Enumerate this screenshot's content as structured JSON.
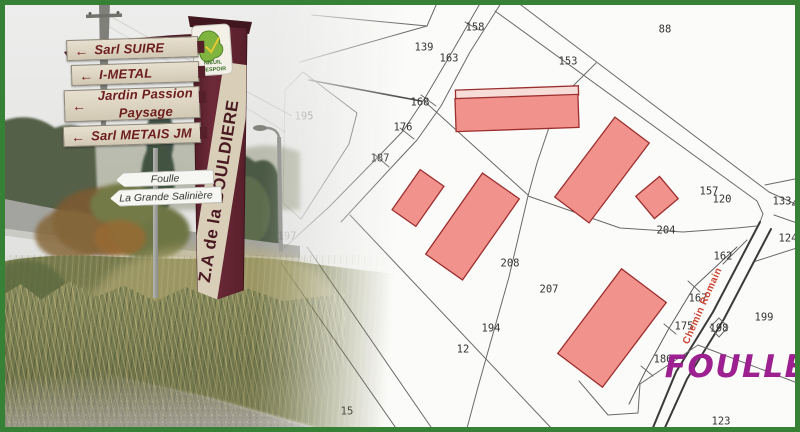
{
  "frame": {
    "border_color": "#368136"
  },
  "photo": {
    "post_sign": {
      "text": "Z.A de la BOULDIERE"
    },
    "logo": {
      "line1": "NIEUIL",
      "line2": "L'ESPOIR"
    },
    "directional_signs": {
      "s1": {
        "arrow": "←",
        "l1": "Sarl SUIRE"
      },
      "s2": {
        "arrow": "←",
        "l1": "I-METAL"
      },
      "s3": {
        "arrow": "←",
        "l1": "Jardin Passion",
        "l2": "Paysage"
      },
      "s4": {
        "arrow": "←",
        "l1": "Sarl METAIS JM"
      }
    },
    "arrow_signs": {
      "a": {
        "label": "Foulle"
      },
      "b": {
        "label": "La Grande Salinière"
      }
    }
  },
  "map": {
    "watermark": "FOULLE",
    "road_label": "Chemin Romain",
    "road_label_pos": {
      "x": 705,
      "y": 307,
      "angle": -66
    },
    "watermark_pos": {
      "x": 736,
      "y": 377
    },
    "colors": {
      "bg": "#fbfbf9",
      "line": "#6a6a6a",
      "label": "#333333",
      "building_fill": "#f2928c",
      "building_stroke": "#9c2f2f",
      "watermark": "#9c2090",
      "road_label_color": "#cc4433"
    },
    "parcel_labels": [
      {
        "t": "139",
        "x": 424,
        "y": 47
      },
      {
        "t": "158",
        "x": 475,
        "y": 27
      },
      {
        "t": "163",
        "x": 449,
        "y": 58
      },
      {
        "t": "153",
        "x": 568,
        "y": 61
      },
      {
        "t": "88",
        "x": 665,
        "y": 29
      },
      {
        "t": "168",
        "x": 420,
        "y": 102
      },
      {
        "t": "176",
        "x": 403,
        "y": 127
      },
      {
        "t": "187",
        "x": 380,
        "y": 158
      },
      {
        "t": "195",
        "x": 304,
        "y": 116
      },
      {
        "t": "197",
        "x": 287,
        "y": 236
      },
      {
        "t": "208",
        "x": 510,
        "y": 263
      },
      {
        "t": "207",
        "x": 549,
        "y": 289
      },
      {
        "t": "204",
        "x": 666,
        "y": 230
      },
      {
        "t": "194",
        "x": 491,
        "y": 328
      },
      {
        "t": "12",
        "x": 463,
        "y": 349
      },
      {
        "t": "15",
        "x": 347,
        "y": 411
      },
      {
        "t": "157",
        "x": 709,
        "y": 191
      },
      {
        "t": "120",
        "x": 722,
        "y": 199
      },
      {
        "t": "133",
        "x": 782,
        "y": 201
      },
      {
        "t": "49",
        "x": 798,
        "y": 204
      },
      {
        "t": "124",
        "x": 788,
        "y": 238
      },
      {
        "t": "162",
        "x": 723,
        "y": 256
      },
      {
        "t": "167",
        "x": 698,
        "y": 298
      },
      {
        "t": "175",
        "x": 684,
        "y": 326
      },
      {
        "t": "198",
        "x": 719,
        "y": 328
      },
      {
        "t": "199",
        "x": 764,
        "y": 317
      },
      {
        "t": "186",
        "x": 663,
        "y": 359
      },
      {
        "t": "123",
        "x": 721,
        "y": 421
      }
    ],
    "buildings": [
      {
        "cx": 517,
        "cy": 92.5,
        "w": 123,
        "h": 9,
        "a": -2,
        "f": "#f7ddd8"
      },
      {
        "cx": 517,
        "cy": 113,
        "w": 123,
        "h": 33,
        "a": -2
      },
      {
        "cx": 418,
        "cy": 198,
        "w": 29,
        "h": 49,
        "a": 35
      },
      {
        "cx": 472.5,
        "cy": 226.5,
        "w": 45,
        "h": 99,
        "a": 35
      },
      {
        "cx": 602,
        "cy": 170,
        "w": 43,
        "h": 100,
        "a": 37
      },
      {
        "cx": 657,
        "cy": 197.5,
        "w": 29,
        "h": 31,
        "a": 50
      },
      {
        "cx": 612,
        "cy": 328,
        "w": 56,
        "h": 106,
        "a": 37
      }
    ],
    "lines": [
      {
        "p": "482,0 452,52 425,98 403,131 377,158 329,207 284,248"
      },
      {
        "p": "503,0 470,52 441,106 417,140 389,170 341,222"
      },
      {
        "p": "465,22 479,30"
      },
      {
        "p": "421,95 436,106"
      },
      {
        "p": "400,128 414,139"
      },
      {
        "p": "374,154 389,167"
      },
      {
        "p": "312,15 427,26"
      },
      {
        "p": "300,62 427,26"
      },
      {
        "p": "427,26 437,3"
      },
      {
        "p": "303,72 357,113 349,144 301,219 283,203 285,90 303,72"
      },
      {
        "p": "309,80 421,101",
        "c": "#4f4f4f",
        "w": 1.6
      },
      {
        "p": "517,2 769,192 800,206"
      },
      {
        "p": "495,11 757,201 763,214 760,222"
      },
      {
        "p": "765,185 800,178"
      },
      {
        "p": "774,215 800,224"
      },
      {
        "p": "753,262 800,247"
      },
      {
        "p": "747,240 723,264"
      },
      {
        "p": "760,222 713,312 676,372 652,430",
        "c": "#3a3a3a",
        "w": 2
      },
      {
        "p": "771,229 724,319 687,379 663,432",
        "c": "#3a3a3a",
        "w": 2
      },
      {
        "p": "737,247 694,287 668,330 645,372 629,404",
        "c": "#5d5d5d"
      },
      {
        "p": "688,281 700,292"
      },
      {
        "p": "664,324 676,334"
      },
      {
        "p": "641,366 653,376"
      },
      {
        "p": "596,63 558,101 537,163 528,196 509,277 478,387 466,432"
      },
      {
        "p": "528,196 620,228 683,232 737,228 757,226"
      },
      {
        "p": "423,100 528,195"
      },
      {
        "p": "307,247 433,430"
      },
      {
        "p": "281,263 398,431"
      },
      {
        "p": "350,215 554,431"
      },
      {
        "p": "579,381 608,415 638,413 640,384"
      },
      {
        "p": "640,384 698,345"
      },
      {
        "p": "698,345 800,384"
      },
      {
        "p": "719,318 728,327 719,337 710,327 719,318"
      }
    ]
  }
}
